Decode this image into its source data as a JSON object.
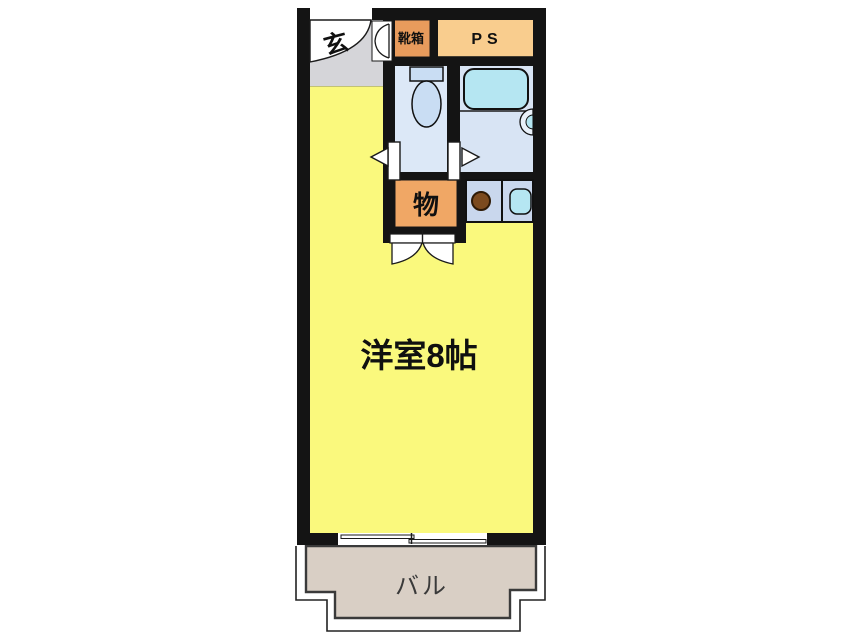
{
  "plan": {
    "type": "apartment-floor-plan",
    "labels": {
      "entrance": "玄",
      "shoe_box": "靴箱",
      "pipe_space": "PS",
      "closet": "物",
      "main_room": "洋室8帖",
      "balcony": "バル"
    },
    "colors": {
      "wall": "#141414",
      "background": "#FFFFFF",
      "main_room": "#FAF97D",
      "entrance_floor": "#D5D5D9",
      "shoe_box": "#E89B5C",
      "pipe_space": "#F9CD8E",
      "closet": "#F0A765",
      "toilet_room": "#DCE8F7",
      "bathroom": "#D8E4F4",
      "kitchen_counter": "#C9D7ED",
      "bathtub": "#B5E6F2",
      "sink": "#B5E6F2",
      "burner": "#7B4A1E",
      "balcony_floor": "#D9CFC5",
      "door_symbol": "#FFFFFF"
    }
  }
}
